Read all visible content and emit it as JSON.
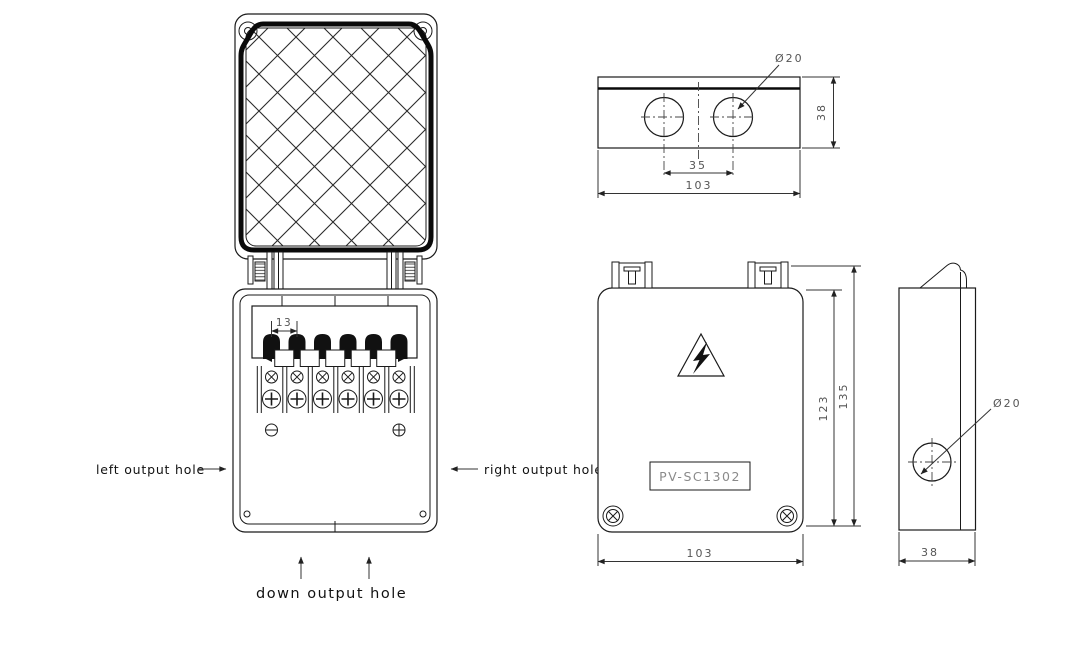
{
  "drawing": {
    "title_hint": "PV junction box technical drawing",
    "colors": {
      "background": "#ffffff",
      "line": "#1a1a1a",
      "dim_text": "#555555",
      "solid_fill": "#111111",
      "model_text": "#8a8a8a"
    },
    "open_view": {
      "left_label": "left output hole",
      "right_label": "right output hole",
      "down_label": "down output hole",
      "terminal_pitch": "13"
    },
    "top_view": {
      "hole_dia": "Ø20",
      "hole_spacing": "35",
      "width": "103",
      "depth": "38"
    },
    "front_view": {
      "model": "PV-SC1302",
      "body_height": "123",
      "total_height": "135",
      "width": "103"
    },
    "side_view": {
      "hole_dia": "Ø20",
      "depth": "38"
    }
  }
}
